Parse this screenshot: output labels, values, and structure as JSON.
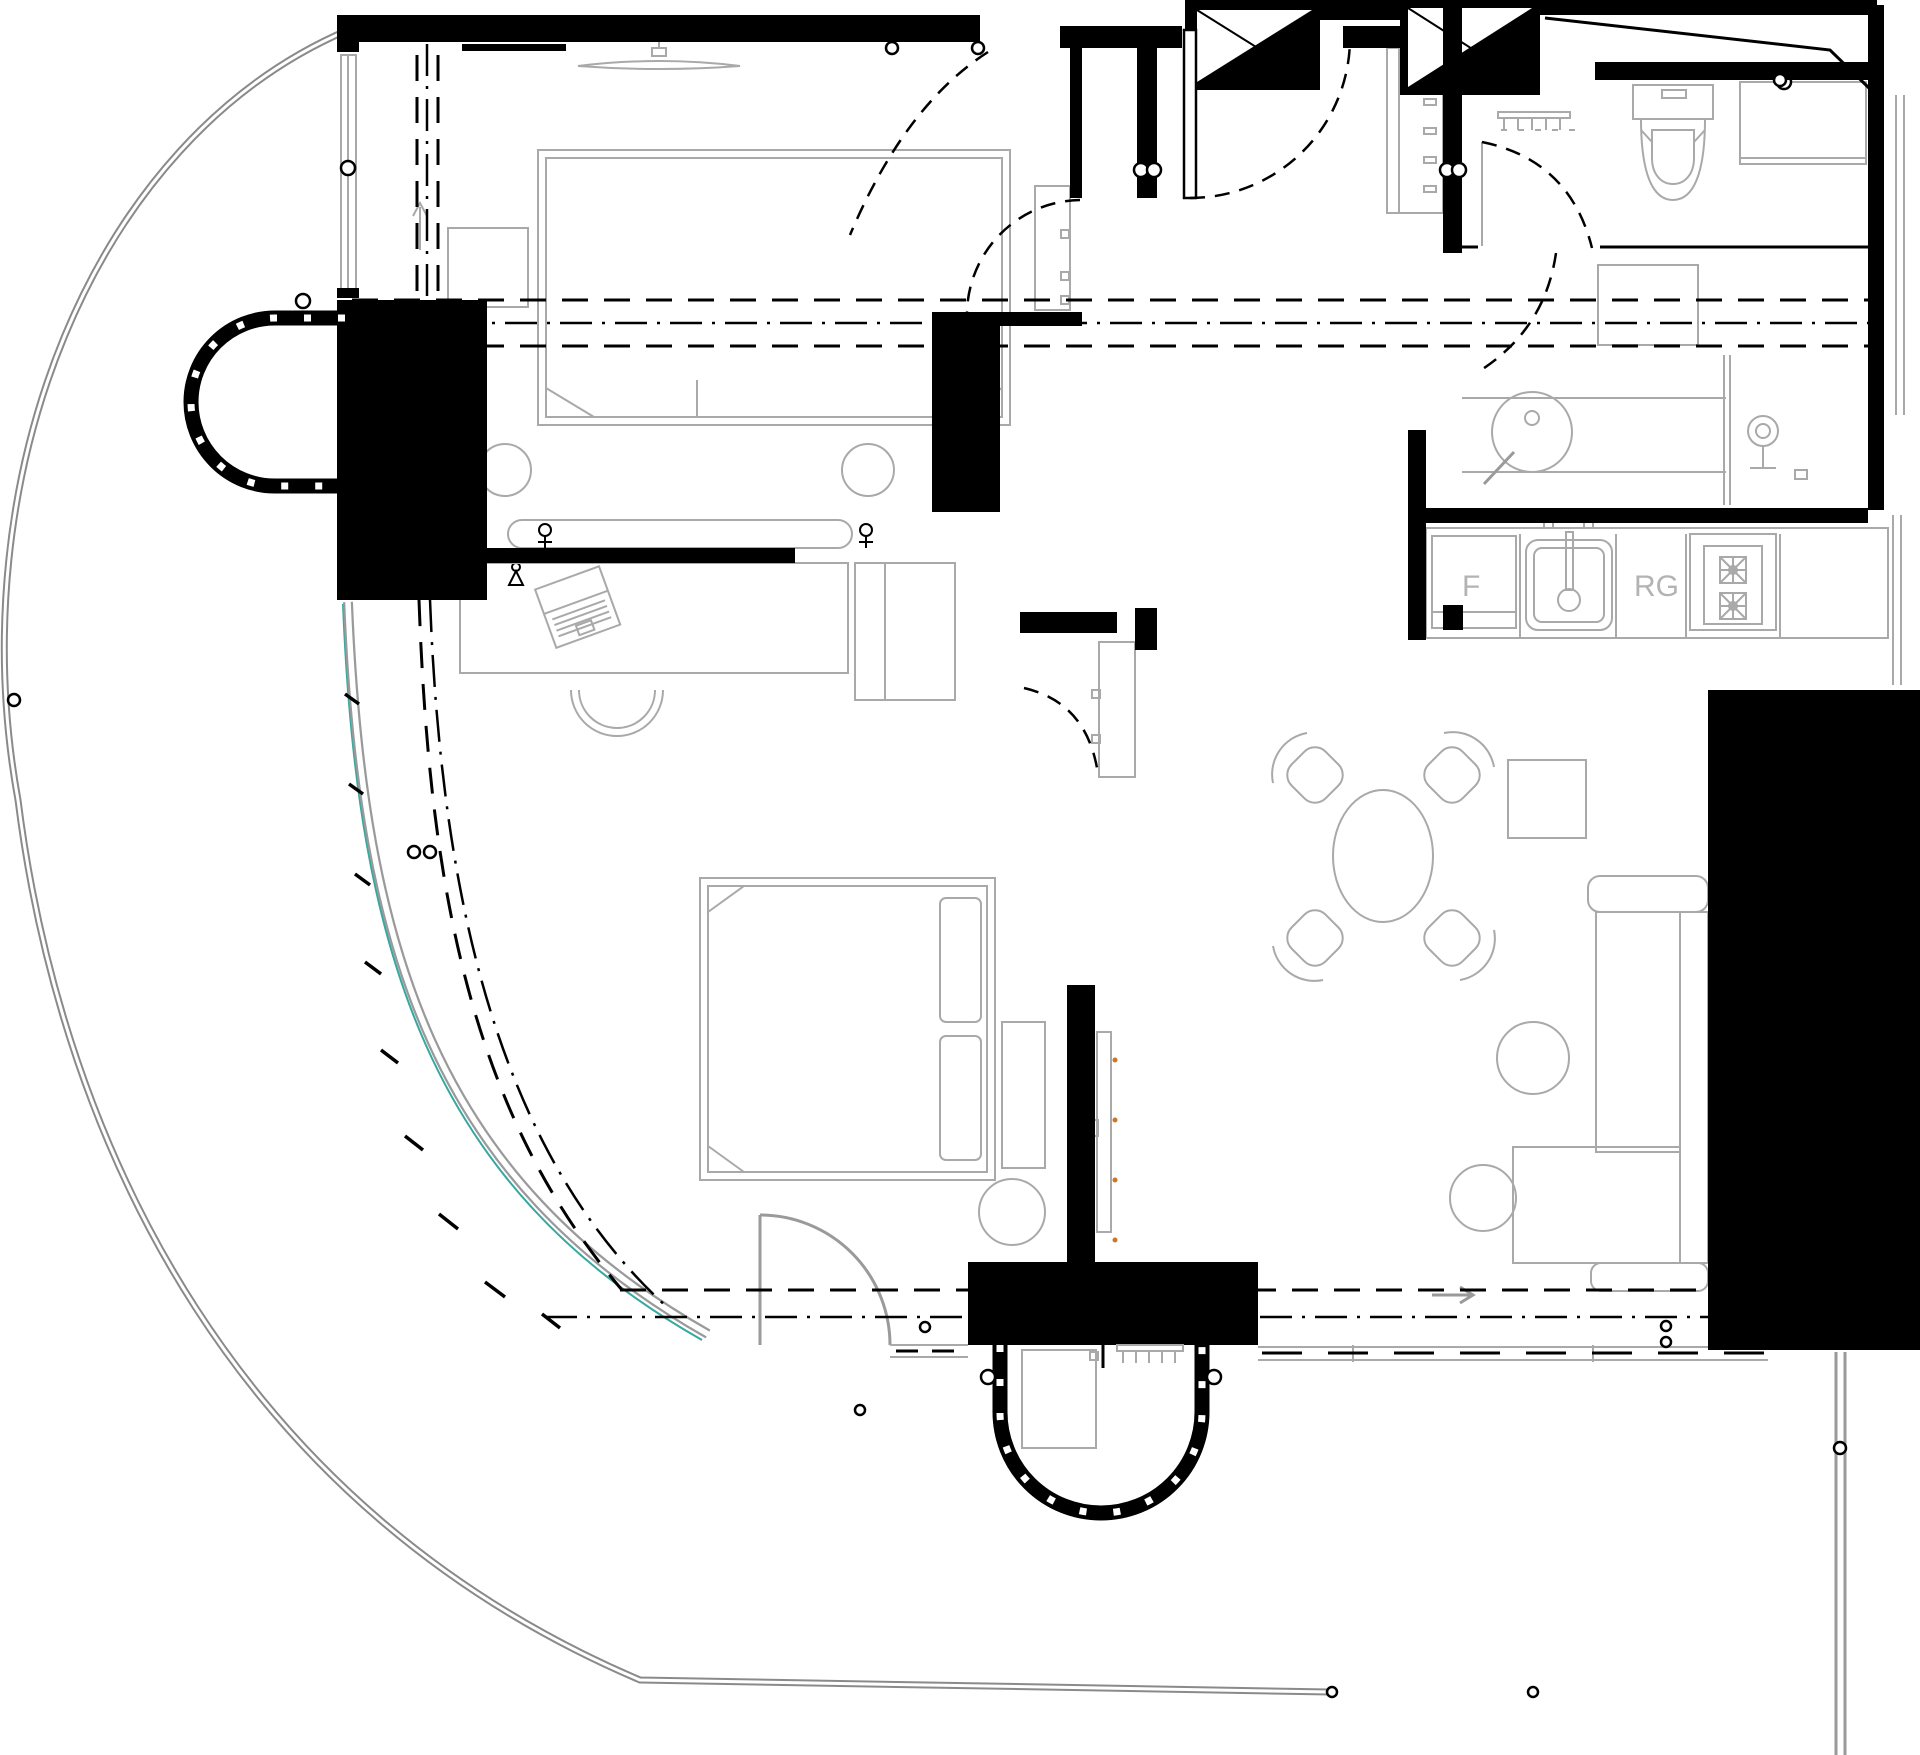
{
  "drawing": {
    "type": "apartment floor plan",
    "labels": {
      "fridge": "F",
      "range": "RG"
    },
    "colors": {
      "walls": "#000000",
      "furniture_lines": "#a9a9a9",
      "terrace_edge": "#8a8a8a",
      "glazing_accent": "#35a8a0",
      "marker_dots": "#c87828",
      "background": "#ffffff"
    }
  }
}
